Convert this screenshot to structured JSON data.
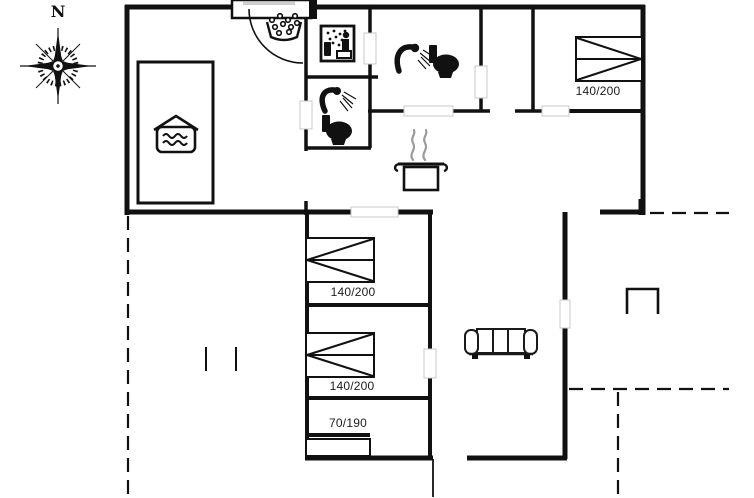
{
  "colors": {
    "line": "#111111",
    "steam": "#9a9a9a"
  },
  "floorplan": {
    "compass_label": "N",
    "bed_labels": {
      "bedroom_ne": "140/200",
      "bedroom_mid_upper": "140/200",
      "bedroom_mid_lower": "140/200",
      "bed_single": "70/190"
    }
  }
}
